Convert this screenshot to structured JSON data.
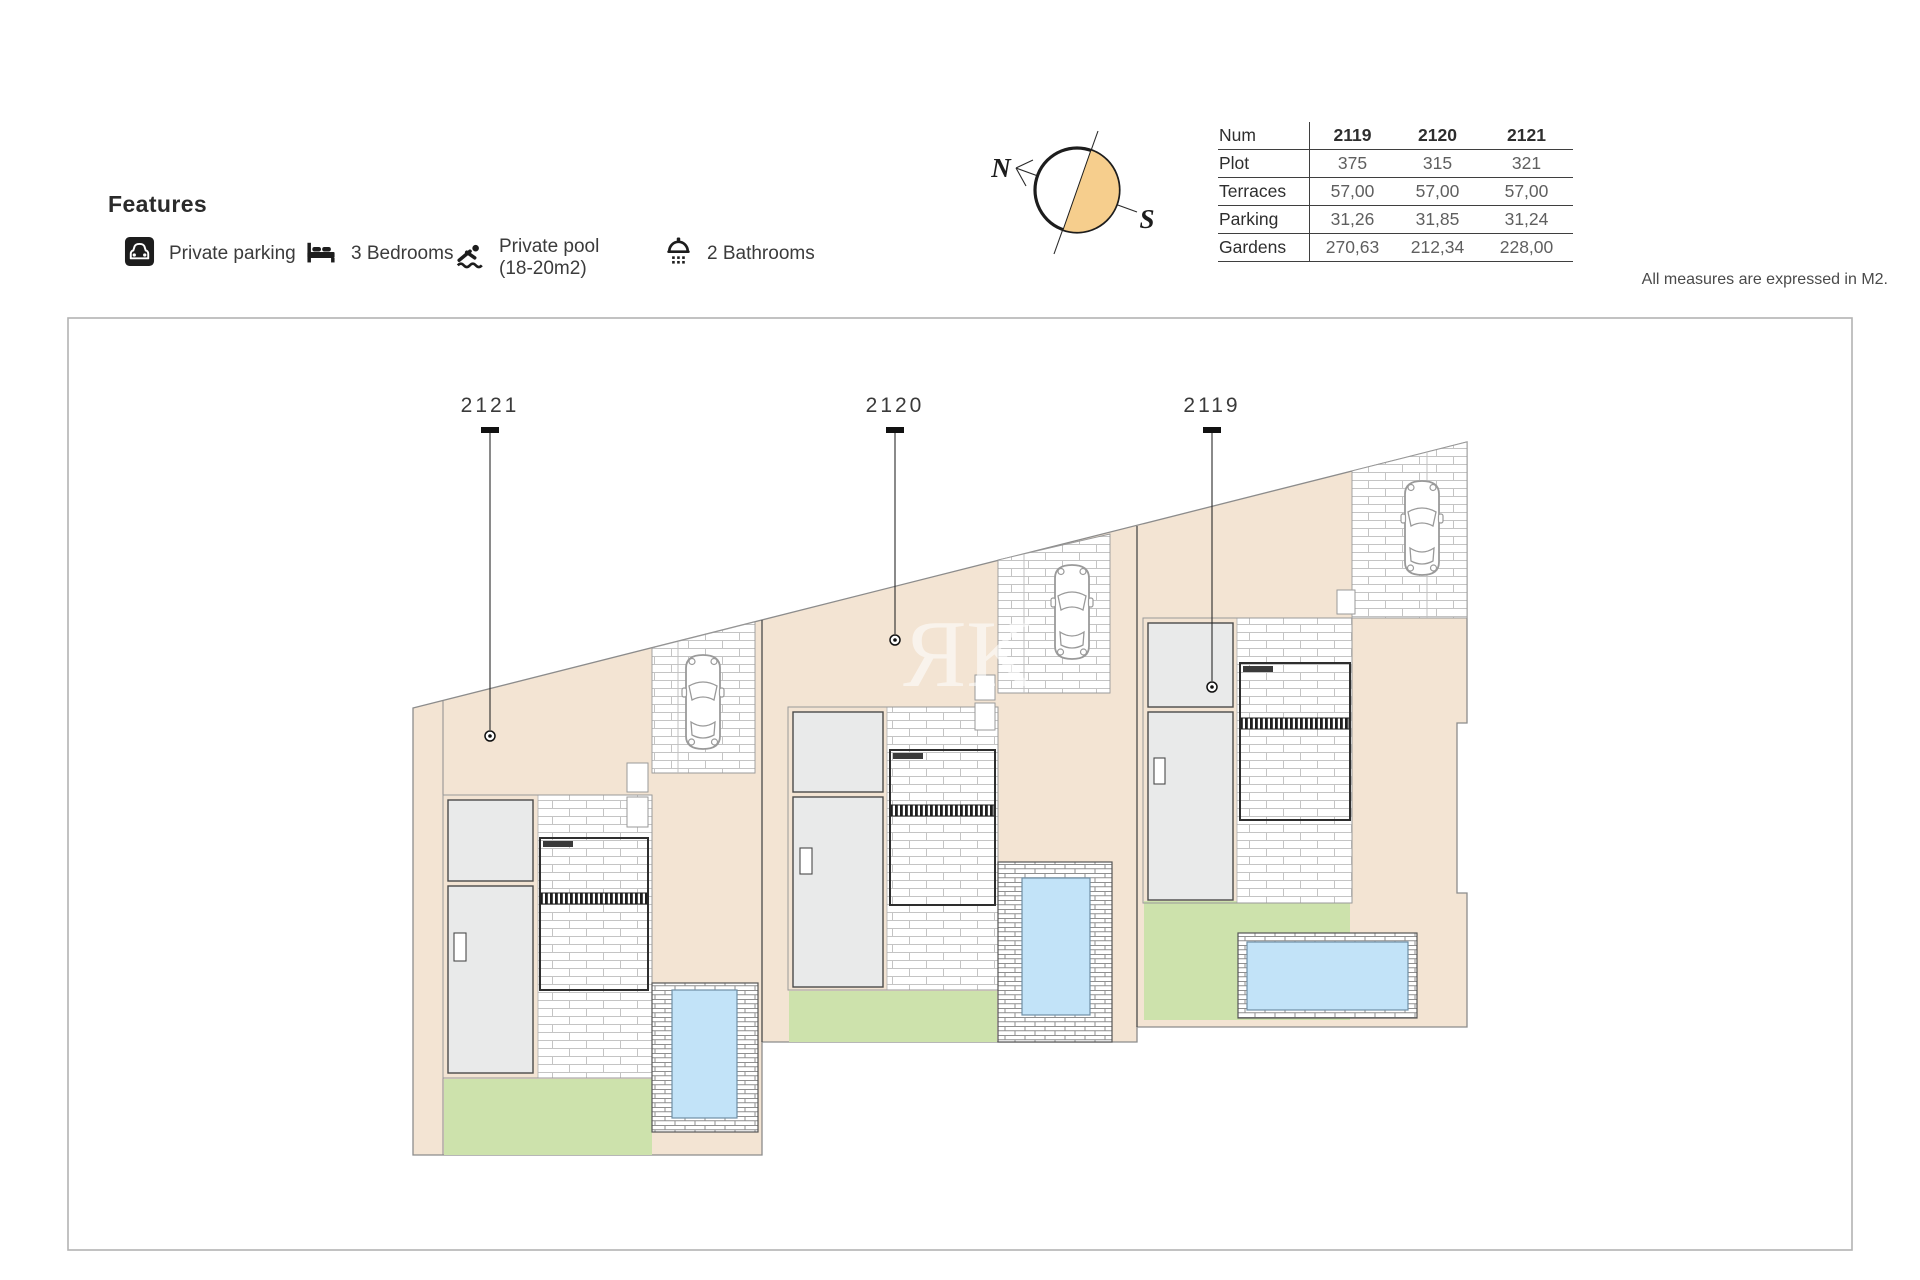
{
  "features": {
    "title": "Features",
    "items": [
      {
        "icon": "private-parking-icon",
        "label": "Private parking"
      },
      {
        "icon": "bedrooms-icon",
        "label": "3 Bedrooms"
      },
      {
        "icon": "private-pool-icon",
        "label": "Private pool",
        "label2": "(18-20m2)"
      },
      {
        "icon": "bathrooms-icon",
        "label": "2 Bathrooms"
      }
    ]
  },
  "compass": {
    "north": "N",
    "south": "S",
    "wedge_color": "#F6CE8D"
  },
  "measurements_table": {
    "header": {
      "label": "Num",
      "cols": [
        "2119",
        "2120",
        "2121"
      ]
    },
    "rows": [
      {
        "label": "Plot",
        "values": [
          "375",
          "315",
          "321"
        ]
      },
      {
        "label": "Terraces",
        "values": [
          "57,00",
          "57,00",
          "57,00"
        ]
      },
      {
        "label": "Parking",
        "values": [
          "31,26",
          "31,85",
          "31,24"
        ]
      },
      {
        "label": "Gardens",
        "values": [
          "270,63",
          "212,34",
          "228,00"
        ]
      }
    ]
  },
  "note": "All measures are expressed in M2.",
  "site_plan": {
    "watermark": "ЯK",
    "plot_labels": [
      "2121",
      "2120",
      "2119"
    ],
    "colors": {
      "plot_fill": "#F3E4D3",
      "garden": "#CDE2AC",
      "pool": "#C2E3F8",
      "building": "#E9EAEA",
      "compass_wedge": "#F6CE8D"
    }
  }
}
